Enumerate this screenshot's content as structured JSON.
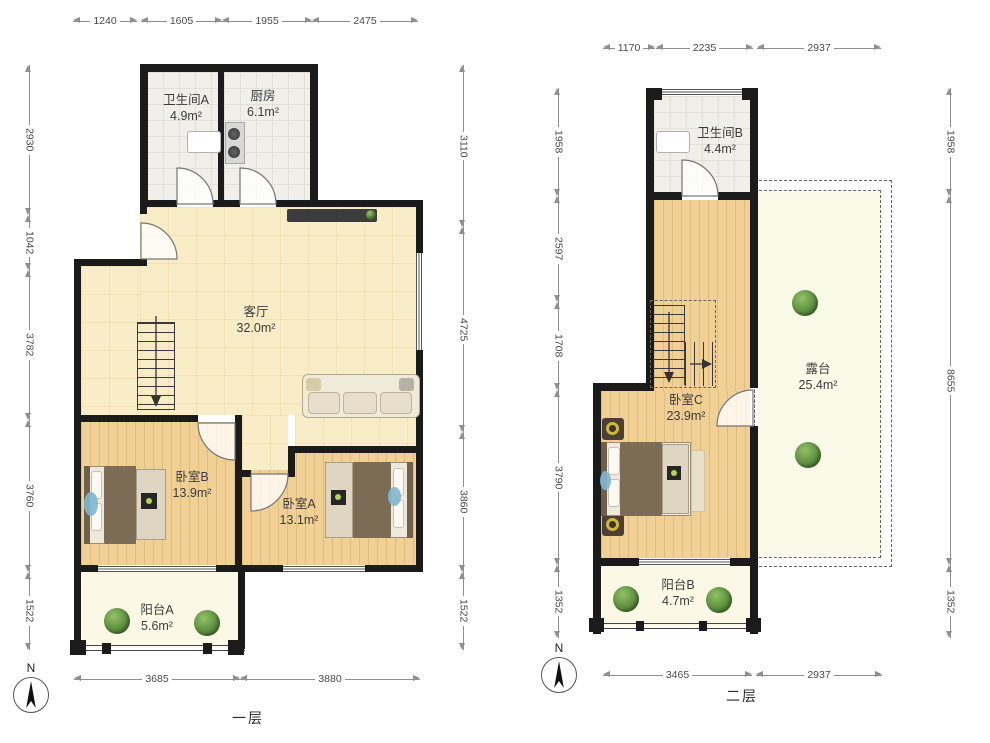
{
  "floor1": {
    "label": "一层",
    "compass": "N",
    "rooms": {
      "bathroomA": {
        "name": "卫生间A",
        "area": "4.9m²"
      },
      "kitchen": {
        "name": "厨房",
        "area": "6.1m²"
      },
      "livingRoom": {
        "name": "客厅",
        "area": "32.0m²"
      },
      "bedroomB": {
        "name": "卧室B",
        "area": "13.9m²"
      },
      "bedroomA": {
        "name": "卧室A",
        "area": "13.1m²"
      },
      "balconyA": {
        "name": "阳台A",
        "area": "5.6m²"
      }
    },
    "dims": {
      "top": [
        "1240",
        "1605",
        "1955",
        "2475"
      ],
      "left": [
        "2930",
        "1042",
        "3782",
        "3760",
        "1522"
      ],
      "right": [
        "3110",
        "4725",
        "3860",
        "1522"
      ],
      "bottom": [
        "3685",
        "3880"
      ]
    }
  },
  "floor2": {
    "label": "二层",
    "compass": "N",
    "rooms": {
      "bathroomB": {
        "name": "卫生间B",
        "area": "4.4m²"
      },
      "bedroomC": {
        "name": "卧室C",
        "area": "23.9m²"
      },
      "terrace": {
        "name": "露台",
        "area": "25.4m²"
      },
      "balconyB": {
        "name": "阳台B",
        "area": "4.7m²"
      }
    },
    "dims": {
      "top": [
        "1170",
        "2235",
        "2937"
      ],
      "left": [
        "1958",
        "2597",
        "1708",
        "3790",
        "1352"
      ],
      "right": [
        "1958",
        "8655",
        "1352"
      ],
      "bottom": [
        "3465",
        "2937"
      ]
    }
  },
  "colors": {
    "wall": "#1b1b1b",
    "woodLight": "#f8edc6",
    "wood": "#f1d096",
    "tile": "#f0efea",
    "balcony": "#fbf9e6",
    "plant": "#5d8f3f"
  }
}
